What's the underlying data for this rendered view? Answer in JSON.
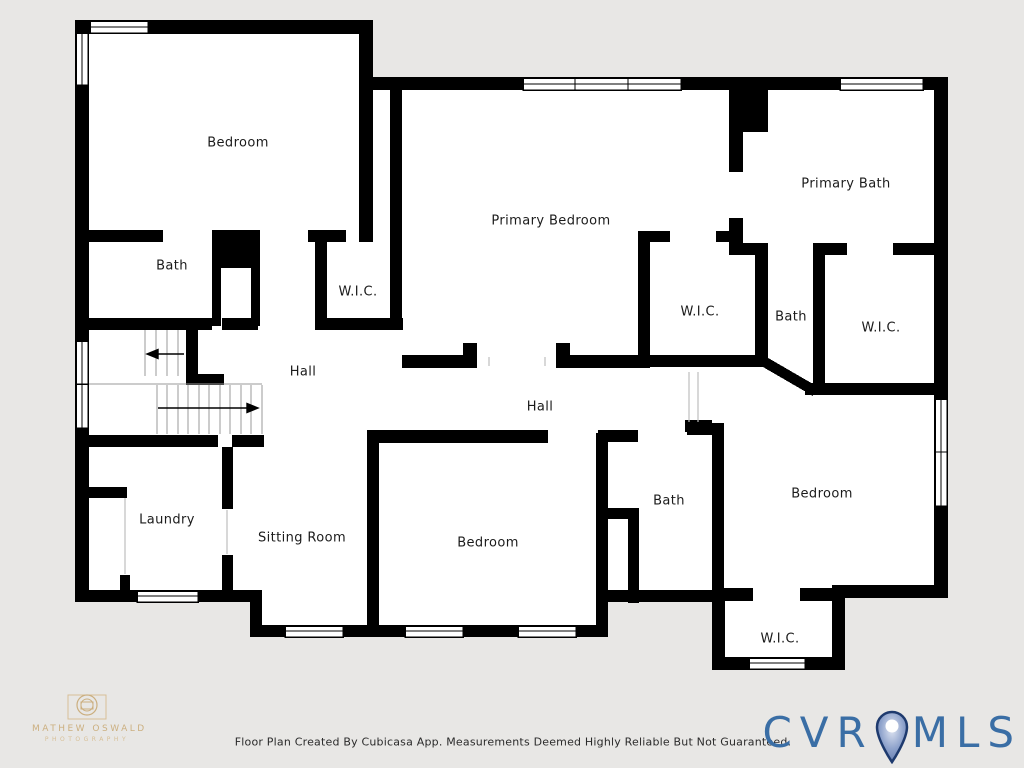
{
  "background_color": "#e8e7e5",
  "plan": {
    "wall_color": "#000000",
    "floor_color": "#ffffff",
    "stair_line_color": "#9a9a9a",
    "rooms": [
      {
        "id": "bedroom-top-left",
        "label": "Bedroom"
      },
      {
        "id": "bath-left",
        "label": "Bath"
      },
      {
        "id": "wic-left",
        "label": "W.I.C."
      },
      {
        "id": "primary-bedroom",
        "label": "Primary Bedroom"
      },
      {
        "id": "primary-bath",
        "label": "Primary Bath"
      },
      {
        "id": "wic-middle",
        "label": "W.I.C."
      },
      {
        "id": "bath-middle",
        "label": "Bath"
      },
      {
        "id": "wic-right",
        "label": "W.I.C."
      },
      {
        "id": "hall-left",
        "label": "Hall"
      },
      {
        "id": "hall-center",
        "label": "Hall"
      },
      {
        "id": "laundry",
        "label": "Laundry"
      },
      {
        "id": "sitting-room",
        "label": "Sitting Room"
      },
      {
        "id": "bedroom-bottom",
        "label": "Bedroom"
      },
      {
        "id": "bath-bottom",
        "label": "Bath"
      },
      {
        "id": "bedroom-right",
        "label": "Bedroom"
      },
      {
        "id": "wic-bottom",
        "label": "W.I.C."
      }
    ]
  },
  "footer": {
    "disclaimer": "Floor Plan Created By Cubicasa App. Measurements Deemed Highly Reliable But Not Guaranteed."
  },
  "watermark": {
    "name": "MATHEW OSWALD",
    "subtitle": "PHOTOGRAPHY",
    "color": "#c5a267"
  },
  "brand": {
    "left": "CVR",
    "right": "MLS",
    "text_color": "#3a6ea5",
    "pin_outline": "#1e3a6e",
    "pin_fill": "#8fa3cc"
  }
}
